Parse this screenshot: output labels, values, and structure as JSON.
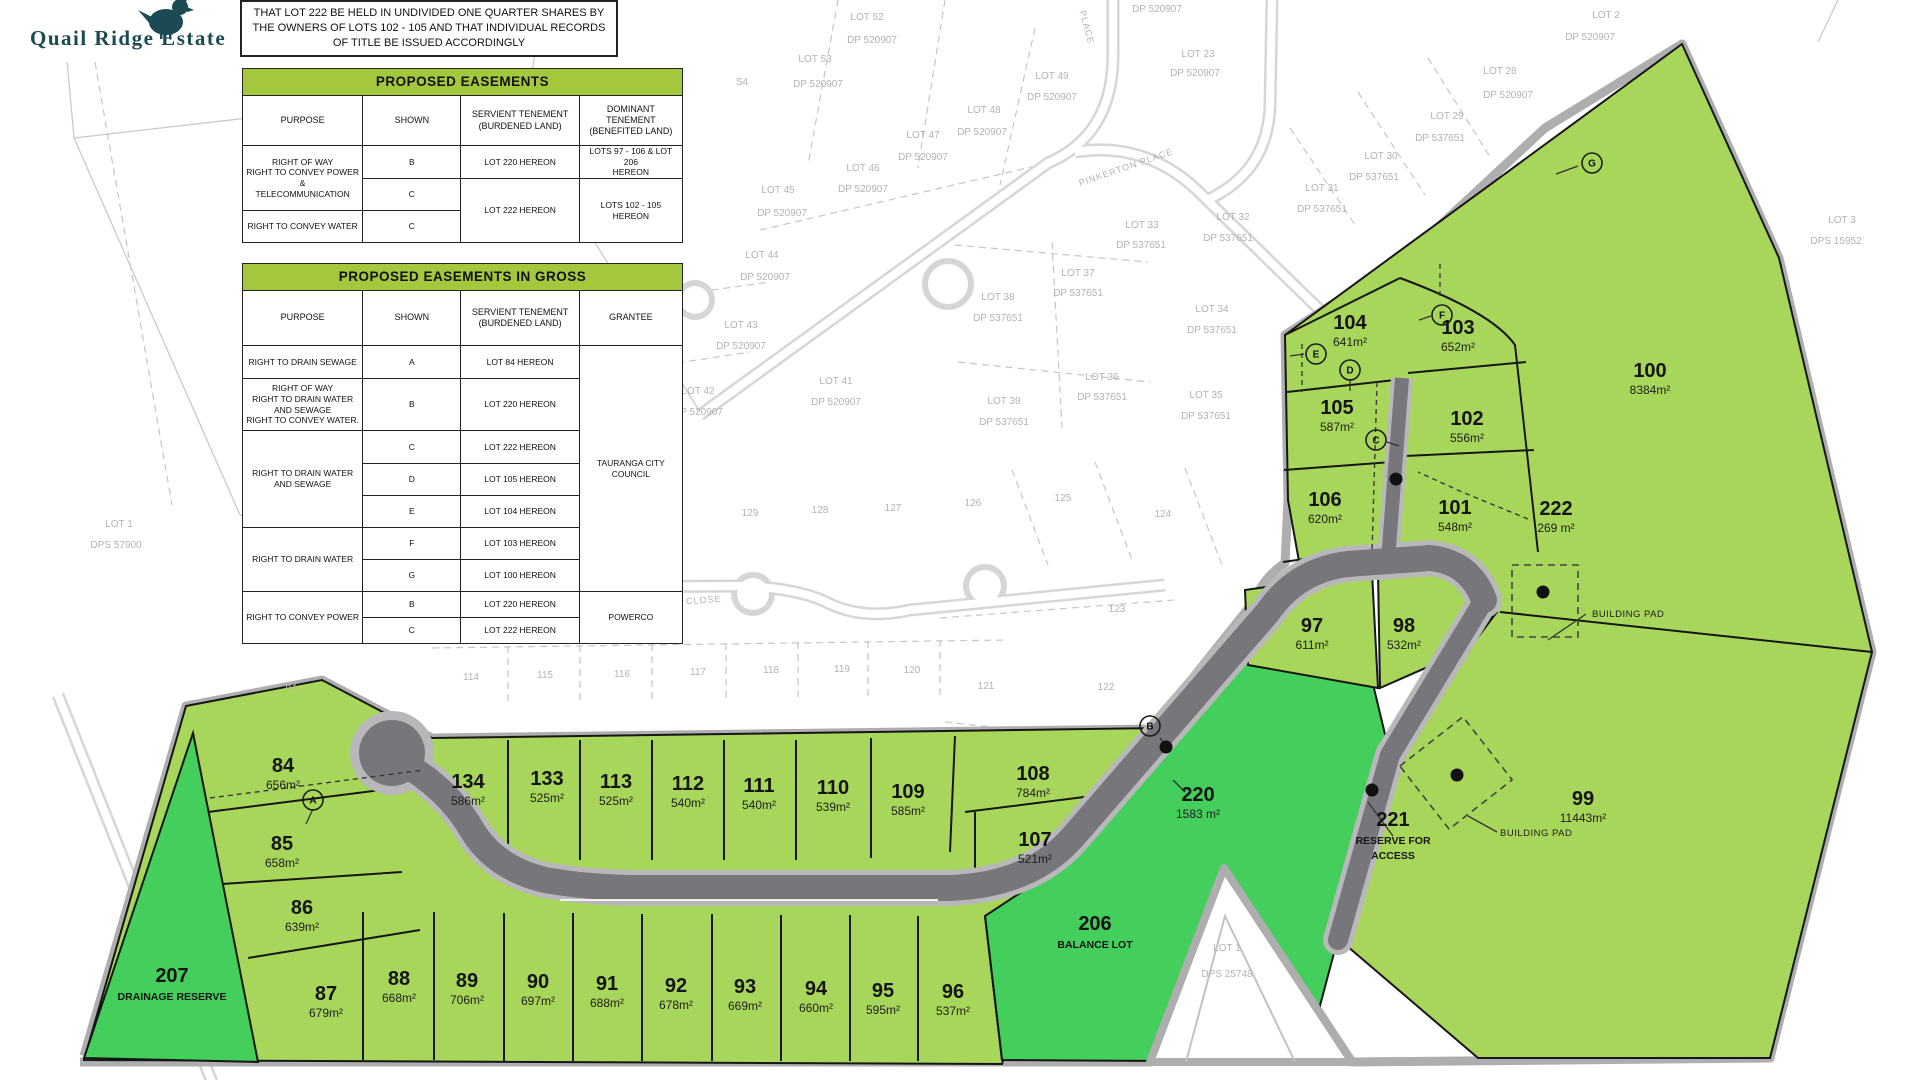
{
  "logo": {
    "title": "Quail Ridge Estate"
  },
  "note": {
    "text": "THAT LOT 222 BE HELD IN UNDIVIDED ONE QUARTER SHARES BY THE OWNERS OF LOTS 102 - 105 AND THAT INDIVIDUAL RECORDS OF TITLE BE ISSUED ACCORDINGLY"
  },
  "colors": {
    "lot_green_light": "#a7d65b",
    "lot_green_dark": "#44ce5b",
    "table_header_green": "#a3c83e",
    "road_gray": "#77777b",
    "boundary_gray": "#aeaeb0",
    "logo_teal": "#1b4a53"
  },
  "tables": {
    "easements": {
      "title": "PROPOSED EASEMENTS",
      "col_widths": [
        120,
        98,
        118,
        103
      ],
      "head_height": 50,
      "columns": [
        "PURPOSE",
        "SHOWN",
        "SERVIENT TENEMENT\n(BURDENED LAND)",
        "DOMINANT TENEMENT\n(BENEFITED LAND)"
      ],
      "row_heights": [
        33,
        32,
        32
      ],
      "rows": [
        [
          {
            "t": "RIGHT OF WAY\nRIGHT TO CONVEY POWER &\nTELECOMMUNICATION",
            "rs": 2
          },
          {
            "t": "B"
          },
          {
            "t": "LOT 220 HEREON"
          },
          {
            "t": "LOTS 97 - 106 & LOT 206\nHEREON"
          }
        ],
        [
          {
            "t": "C"
          },
          {
            "t": "LOT 222 HEREON",
            "rs": 2
          },
          {
            "t": "LOTS 102 - 105 HEREON",
            "rs": 2
          }
        ],
        [
          {
            "t": "RIGHT TO CONVEY WATER"
          },
          {
            "t": "C"
          }
        ]
      ]
    },
    "easements_in_gross": {
      "title": "PROPOSED EASEMENTS IN GROSS",
      "col_widths": [
        120,
        98,
        118,
        103
      ],
      "head_height": 55,
      "columns": [
        "PURPOSE",
        "SHOWN",
        "SERVIENT TENEMENT\n(BURDENED LAND)",
        "GRANTEE"
      ],
      "row_heights": [
        33,
        52,
        33,
        32,
        32,
        32,
        32,
        26,
        26
      ],
      "rows": [
        [
          {
            "t": "RIGHT TO DRAIN SEWAGE"
          },
          {
            "t": "A"
          },
          {
            "t": "LOT 84 HEREON"
          },
          {
            "t": "TAURANGA CITY COUNCIL",
            "rs": 7
          }
        ],
        [
          {
            "t": "RIGHT OF WAY\nRIGHT TO DRAIN WATER\nAND SEWAGE\nRIGHT TO CONVEY WATER."
          },
          {
            "t": "B"
          },
          {
            "t": "LOT 220 HEREON"
          }
        ],
        [
          {
            "t": "RIGHT TO DRAIN WATER\nAND SEWAGE",
            "rs": 3
          },
          {
            "t": "C"
          },
          {
            "t": "LOT 222 HEREON"
          }
        ],
        [
          {
            "t": "D"
          },
          {
            "t": "LOT 105 HEREON"
          }
        ],
        [
          {
            "t": "E"
          },
          {
            "t": "LOT 104 HEREON"
          }
        ],
        [
          {
            "t": "RIGHT TO DRAIN WATER",
            "rs": 2
          },
          {
            "t": "F"
          },
          {
            "t": "LOT 103 HEREON"
          }
        ],
        [
          {
            "t": "G"
          },
          {
            "t": "LOT 100 HEREON"
          }
        ],
        [
          {
            "t": "RIGHT TO CONVEY POWER",
            "rs": 2
          },
          {
            "t": "B"
          },
          {
            "t": "LOT 220 HEREON"
          },
          {
            "t": "POWERCO",
            "rs": 2
          }
        ],
        [
          {
            "t": "C"
          },
          {
            "t": "LOT 222 HEREON"
          }
        ]
      ]
    }
  },
  "map": {
    "lots": [
      {
        "n": "84",
        "a": "656m²",
        "x": 283,
        "y": 772
      },
      {
        "n": "85",
        "a": "658m²",
        "x": 282,
        "y": 850
      },
      {
        "n": "86",
        "a": "639m²",
        "x": 302,
        "y": 914
      },
      {
        "n": "87",
        "a": "679m²",
        "x": 326,
        "y": 1000
      },
      {
        "n": "88",
        "a": "668m²",
        "x": 399,
        "y": 985
      },
      {
        "n": "89",
        "a": "706m²",
        "x": 467,
        "y": 987
      },
      {
        "n": "90",
        "a": "697m²",
        "x": 538,
        "y": 988
      },
      {
        "n": "91",
        "a": "688m²",
        "x": 607,
        "y": 990
      },
      {
        "n": "92",
        "a": "678m²",
        "x": 676,
        "y": 992
      },
      {
        "n": "93",
        "a": "669m²",
        "x": 745,
        "y": 993
      },
      {
        "n": "94",
        "a": "660m²",
        "x": 816,
        "y": 995
      },
      {
        "n": "95",
        "a": "595m²",
        "x": 883,
        "y": 997
      },
      {
        "n": "96",
        "a": "537m²",
        "x": 953,
        "y": 998
      },
      {
        "n": "134",
        "a": "586m²",
        "x": 468,
        "y": 788
      },
      {
        "n": "133",
        "a": "525m²",
        "x": 547,
        "y": 785
      },
      {
        "n": "113",
        "a": "525m²",
        "x": 616,
        "y": 788
      },
      {
        "n": "112",
        "a": "540m²",
        "x": 688,
        "y": 790
      },
      {
        "n": "111",
        "a": "540m²",
        "x": 759,
        "y": 792
      },
      {
        "n": "110",
        "a": "539m²",
        "x": 833,
        "y": 794
      },
      {
        "n": "109",
        "a": "585m²",
        "x": 908,
        "y": 798
      },
      {
        "n": "108",
        "a": "784m²",
        "x": 1033,
        "y": 780
      },
      {
        "n": "107",
        "a": "521m²",
        "x": 1035,
        "y": 846
      },
      {
        "n": "97",
        "a": "611m²",
        "x": 1312,
        "y": 632
      },
      {
        "n": "98",
        "a": "532m²",
        "x": 1404,
        "y": 632
      },
      {
        "n": "99",
        "a": "11443m²",
        "x": 1583,
        "y": 805
      },
      {
        "n": "100",
        "a": "8384m²",
        "x": 1650,
        "y": 377
      },
      {
        "n": "101",
        "a": "548m²",
        "x": 1455,
        "y": 514
      },
      {
        "n": "102",
        "a": "556m²",
        "x": 1467,
        "y": 425
      },
      {
        "n": "103",
        "a": "652m²",
        "x": 1458,
        "y": 334
      },
      {
        "n": "104",
        "a": "641m²",
        "x": 1350,
        "y": 329
      },
      {
        "n": "105",
        "a": "587m²",
        "x": 1337,
        "y": 414
      },
      {
        "n": "106",
        "a": "620m²",
        "x": 1325,
        "y": 506
      },
      {
        "n": "220",
        "a": "1583 m²",
        "x": 1198,
        "y": 801
      },
      {
        "n": "222",
        "a": "269 m²",
        "x": 1556,
        "y": 515
      },
      {
        "n": "207",
        "sub": [
          "DRAINAGE RESERVE"
        ],
        "x": 172,
        "y": 982
      },
      {
        "n": "206",
        "sub": [
          "BALANCE LOT"
        ],
        "x": 1095,
        "y": 930
      },
      {
        "n": "221",
        "sub": [
          "RESERVE FOR",
          "ACCESS"
        ],
        "x": 1393,
        "y": 826
      }
    ],
    "bg_labels": [
      [
        "S4",
        742,
        85
      ],
      [
        "LOT 52",
        867,
        20
      ],
      [
        "DP 520907",
        872,
        43
      ],
      [
        "DP 520907",
        1157,
        12
      ],
      [
        "LOT 53",
        815,
        62
      ],
      [
        "DP 520907",
        818,
        87
      ],
      [
        "LOT 49",
        1052,
        79
      ],
      [
        "DP 520907",
        1052,
        100
      ],
      [
        "LOT 48",
        984,
        113
      ],
      [
        "DP 520907",
        982,
        135
      ],
      [
        "LOT 47",
        923,
        138
      ],
      [
        "DP 520907",
        923,
        160
      ],
      [
        "LOT 46",
        863,
        171
      ],
      [
        "DP 520907",
        863,
        192
      ],
      [
        "LOT 45",
        778,
        193
      ],
      [
        "DP 520907",
        782,
        216
      ],
      [
        "LOT 44",
        762,
        258
      ],
      [
        "DP 520907",
        765,
        280
      ],
      [
        "LOT 43",
        741,
        328
      ],
      [
        "DP 520907",
        741,
        349
      ],
      [
        "LOT 42",
        698,
        394
      ],
      [
        "DP 520907",
        698,
        415
      ],
      [
        "LOT 41",
        836,
        384
      ],
      [
        "DP 520907",
        836,
        405
      ],
      [
        "LOT 23",
        1198,
        57
      ],
      [
        "DP 520907",
        1195,
        76
      ],
      [
        "LOT 2",
        1606,
        18
      ],
      [
        "DP 520907",
        1590,
        40
      ],
      [
        "LOT 28",
        1500,
        74
      ],
      [
        "DP 520907",
        1508,
        98
      ],
      [
        "LOT 29",
        1447,
        119
      ],
      [
        "DP 537651",
        1440,
        141
      ],
      [
        "LOT 30",
        1381,
        159
      ],
      [
        "DP 537651",
        1374,
        180
      ],
      [
        "LOT 31",
        1322,
        191
      ],
      [
        "DP 537651",
        1322,
        212
      ],
      [
        "LOT 32",
        1233,
        220
      ],
      [
        "DP 537651",
        1228,
        241
      ],
      [
        "LOT 33",
        1142,
        228
      ],
      [
        "DP 537651",
        1141,
        248
      ],
      [
        "LOT 34",
        1212,
        312
      ],
      [
        "DP 537651",
        1212,
        333
      ],
      [
        "LOT 35",
        1206,
        398
      ],
      [
        "DP 537651",
        1206,
        419
      ],
      [
        "LOT 36",
        1102,
        380
      ],
      [
        "DP 537651",
        1102,
        400
      ],
      [
        "LOT 37",
        1078,
        276
      ],
      [
        "DP 537651",
        1078,
        296
      ],
      [
        "LOT 38",
        998,
        300
      ],
      [
        "DP 537651",
        998,
        321
      ],
      [
        "LOT 39",
        1004,
        404
      ],
      [
        "DP 537651",
        1004,
        425
      ],
      [
        "LOT 3",
        1842,
        223
      ],
      [
        "DPS 15952",
        1836,
        244
      ],
      [
        "LOT 1",
        119,
        527
      ],
      [
        "DPS 57900",
        116,
        548
      ],
      [
        "LOT 1",
        1227,
        951
      ],
      [
        "DPS 25748",
        1227,
        977
      ],
      [
        "129",
        750,
        516
      ],
      [
        "128",
        820,
        513
      ],
      [
        "127",
        893,
        511
      ],
      [
        "126",
        973,
        506
      ],
      [
        "125",
        1063,
        501
      ],
      [
        "124",
        1163,
        517
      ],
      [
        "123",
        1117,
        612
      ],
      [
        "122",
        1106,
        690
      ],
      [
        "121",
        986,
        689
      ],
      [
        "83",
        291,
        689
      ],
      [
        "114",
        471,
        680
      ],
      [
        "115",
        545,
        678
      ],
      [
        "116",
        622,
        677
      ],
      [
        "117",
        698,
        675
      ],
      [
        "118",
        771,
        673
      ],
      [
        "119",
        842,
        672
      ],
      [
        "120",
        912,
        673
      ]
    ],
    "street_labels": [
      [
        "PINKERTON PLACE",
        1127,
        170,
        -19
      ],
      [
        "PLACE",
        1084,
        28,
        75
      ],
      [
        "CLOSE",
        704,
        603,
        -4
      ]
    ],
    "markers": [
      [
        "A",
        313,
        800
      ],
      [
        "B",
        1150,
        726
      ],
      [
        "C",
        1376,
        440
      ],
      [
        "D",
        1350,
        370
      ],
      [
        "E",
        1316,
        354
      ],
      [
        "F",
        1442,
        315
      ],
      [
        "G",
        1592,
        163
      ]
    ],
    "annotations": [
      [
        "BUILDING PAD",
        1592,
        617
      ],
      [
        "BUILDING PAD",
        1500,
        836
      ]
    ]
  }
}
